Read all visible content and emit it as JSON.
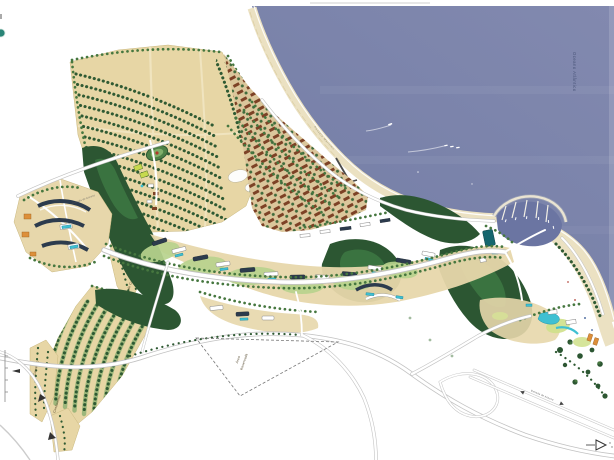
{
  "labels": {
    "ocean": "Oceano Atlântico",
    "reserved_line1": "Área",
    "reserved_line2": "Reservada",
    "cultivation": "Núcleo de Cultivo",
    "west_parcel": "Comércio",
    "south_parcel": "Condomínio",
    "promenade": "Passeio Marítimo",
    "access_road_west": "Estrada de Acesso",
    "access_road_east": "Estrada de Acesso"
  },
  "colors": {
    "sea": "#7a83aa",
    "sea_light": "#8d95b8",
    "harbor": "#6b75a2",
    "beach": "#ebe1c2",
    "sand": "#e7d7ab",
    "field": "#e7d6a5",
    "field_light": "#f0e4bf",
    "tree_dark": "#2f5a33",
    "tree_mid": "#46773f",
    "lawn": "#b7d28d",
    "forest": "#2c5632",
    "village_roof": "#7d4226",
    "building_dark": "#2c3b4d",
    "pool": "#3fc0d2",
    "accent_orange": "#dd8f3a",
    "accent_teal": "#15666e",
    "road_casing": "#c2c2c2",
    "label_dark": "#4a3d20",
    "label_sea": "#3e4a6e"
  }
}
